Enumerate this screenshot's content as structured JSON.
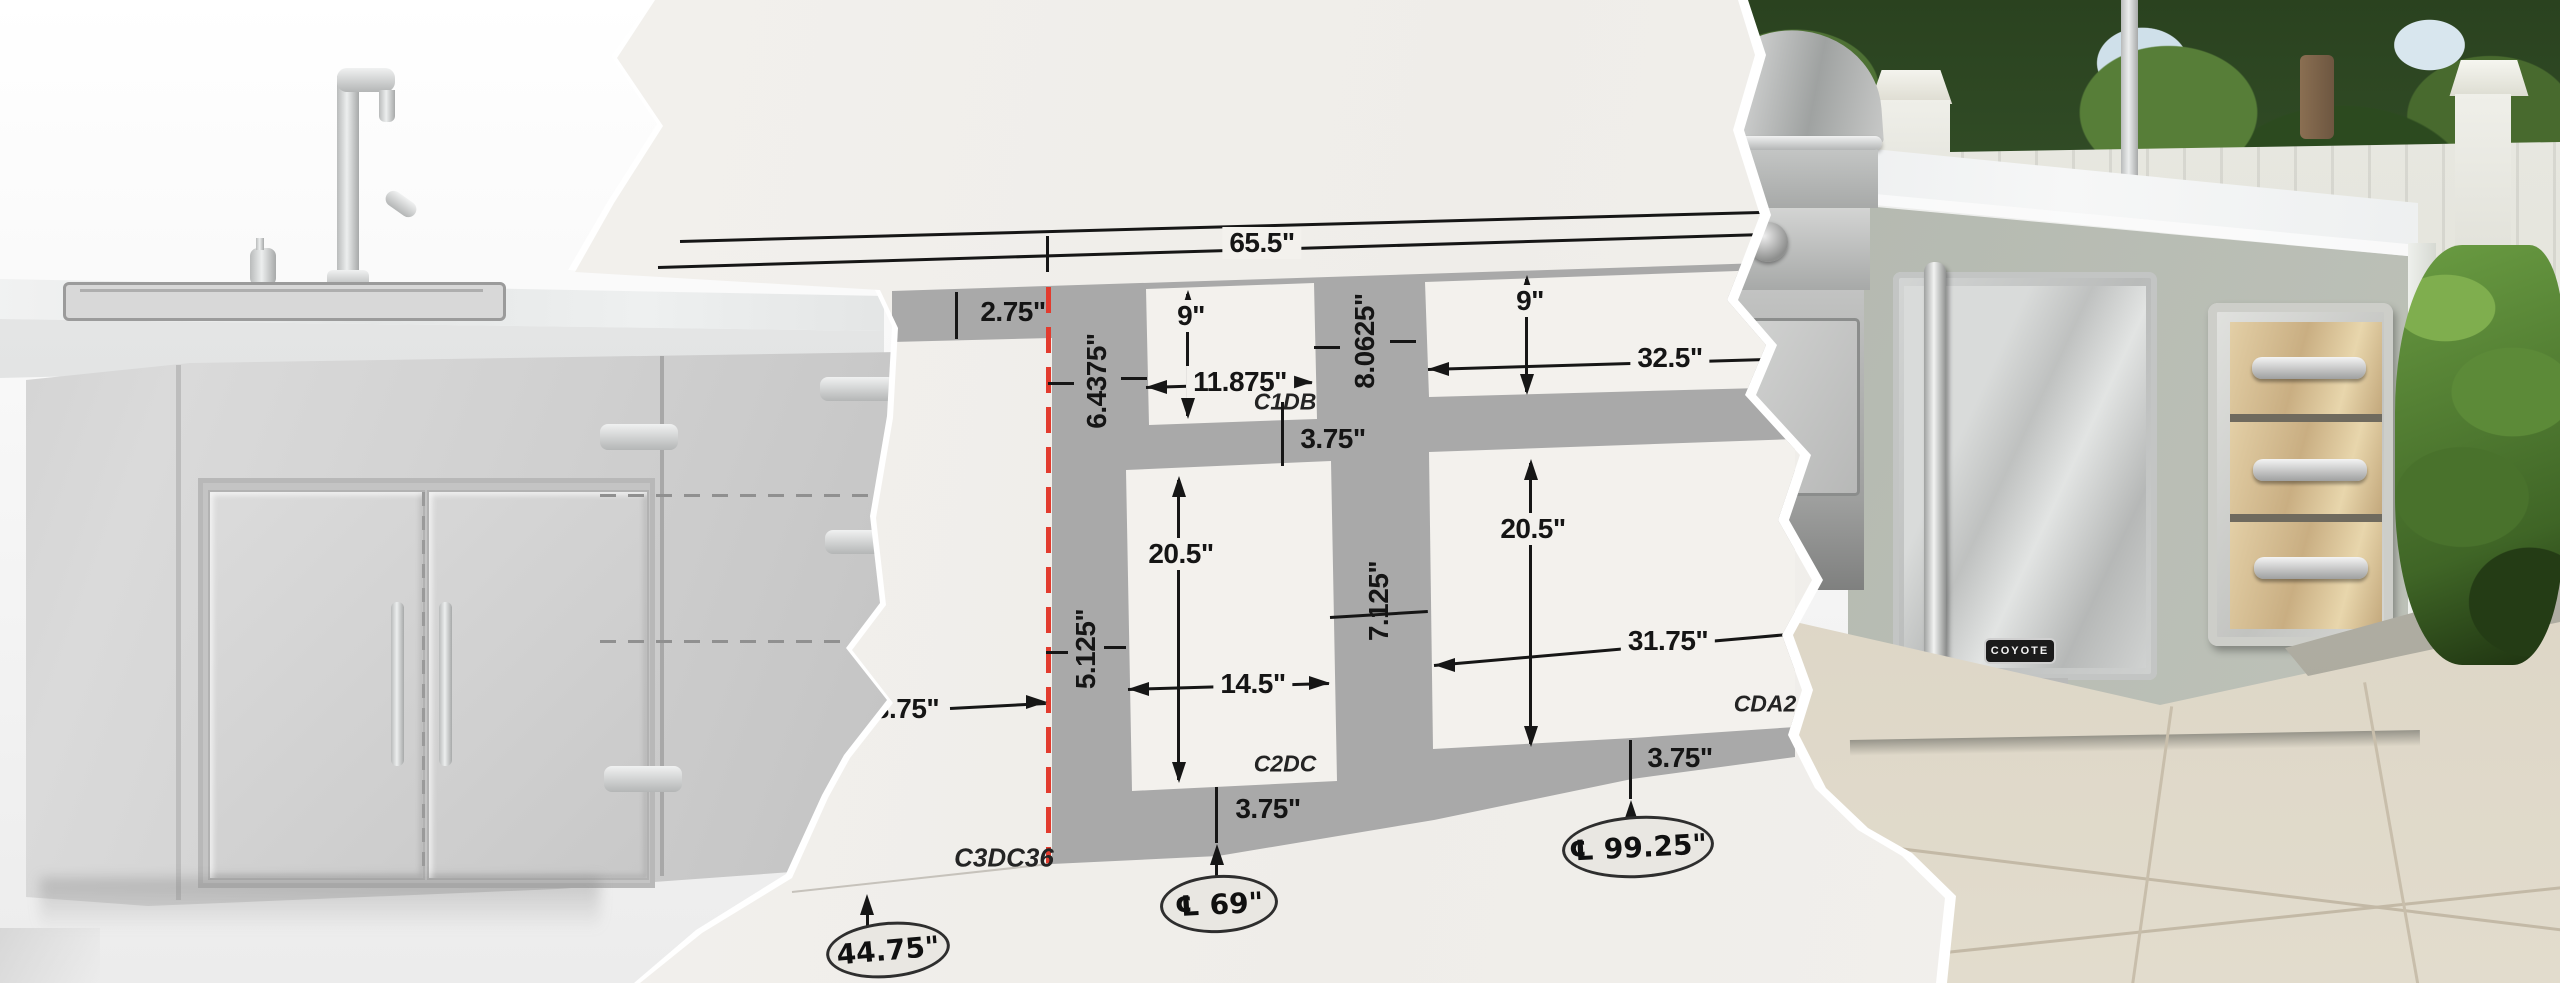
{
  "drawing": {
    "dims": {
      "overall": "65.5\"",
      "offset_left": "2.75\"",
      "end_panel": "6.4375\"",
      "c1db_h": "9\"",
      "c1db_w": "11.875\"",
      "c1db_below": "3.75\"",
      "right_top_h": "8.0625\"",
      "grill_h": "9\"",
      "grill_w": "32.5\"",
      "c2dc_h": "20.5\"",
      "c2dc_w": "14.5\"",
      "stile_left": "5.125\"",
      "stile_mid": "7.125\"",
      "cda_h": "20.5\"",
      "cda_w": "31.75\"",
      "left_run": "23.75\"",
      "c2dc_below": "3.75\"",
      "cda_below": "3.75\""
    },
    "part_labels": {
      "c1db": "C1DB",
      "c2dc": "C2DC",
      "c3dc36": "C3DC36",
      "cda2": "CDA2"
    },
    "badges": {
      "b4475": "44.75\"",
      "b69": "℄ 69\"",
      "b9925": "℄ 99.25\""
    },
    "colors": {
      "paper": "#f3f1ed",
      "cabinet_gray": "#a9a9a9",
      "centerline_red": "#e23b2e",
      "ink": "#161616"
    }
  },
  "photo": {
    "fridge_badge": "COYOTE"
  }
}
